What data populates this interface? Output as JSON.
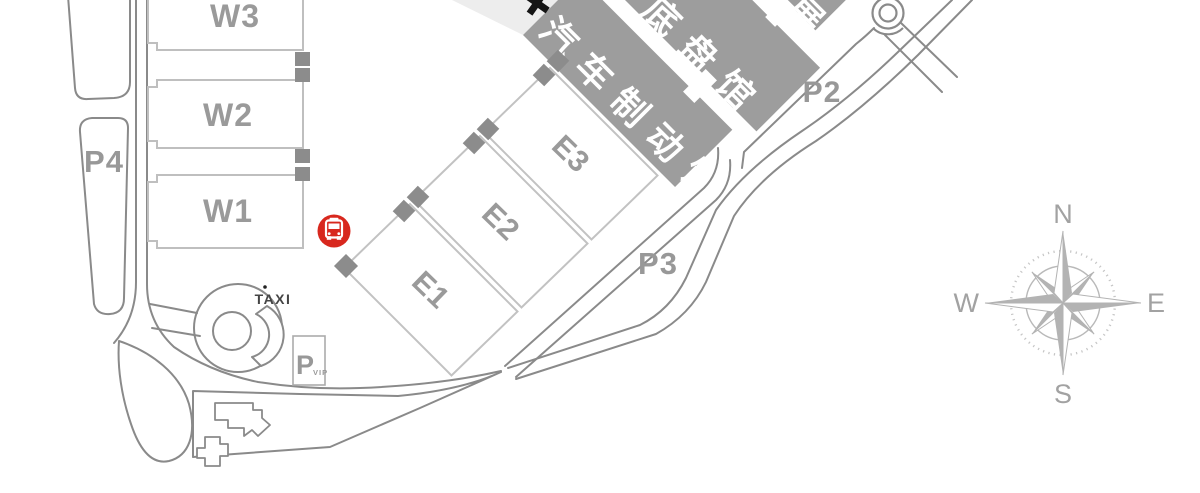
{
  "map": {
    "west_halls": [
      {
        "id": "w3",
        "label": "W3"
      },
      {
        "id": "w2",
        "label": "W2"
      },
      {
        "id": "w1",
        "label": "W1"
      }
    ],
    "east_halls": [
      {
        "id": "e1",
        "label": "E1"
      },
      {
        "id": "e2",
        "label": "E2"
      },
      {
        "id": "e3",
        "label": "E3"
      }
    ],
    "themed_halls": [
      {
        "id": "brake-hall",
        "label": "汽车制动馆"
      },
      {
        "id": "chassis-hall",
        "label": "车底盘馆"
      },
      {
        "id": "exhibit-hall",
        "label": "展"
      }
    ],
    "parking": {
      "p4": "P4",
      "p3": "P3",
      "p2": "P2",
      "vip_main": "P",
      "vip_sub": "VIP"
    },
    "taxi_label": "TAXI",
    "compass": {
      "north": "N",
      "east": "E",
      "south": "S",
      "west": "W"
    },
    "icons": [
      "bus-icon",
      "cross-icon",
      "compass-rose-icon"
    ],
    "colors": {
      "hall_gray": "#9d9d9d",
      "connector_gray": "#8c8c8c",
      "outline_light": "#bfbfbf",
      "road_gray": "#8a8a8a",
      "label_gray": "#9a9a9a",
      "bus_red": "#d8281e",
      "band_gray": "#ededed"
    }
  }
}
